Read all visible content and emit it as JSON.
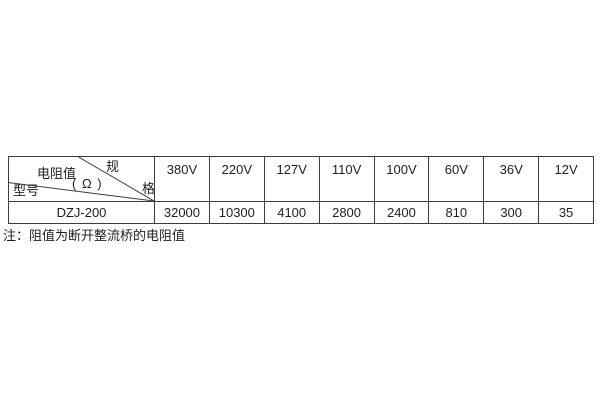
{
  "table": {
    "corner": {
      "spec_char1": "规",
      "spec_char2": "格",
      "resistance_label": "电阻值",
      "resistance_unit": "( Ω )",
      "model_label": "型号"
    },
    "voltages": [
      "380V",
      "220V",
      "127V",
      "110V",
      "100V",
      "60V",
      "36V",
      "12V"
    ],
    "model": "DZJ-200",
    "values": [
      "32000",
      "10300",
      "4100",
      "2800",
      "2400",
      "810",
      "300",
      "35"
    ]
  },
  "note": "注：阻值为断开整流桥的电阻值",
  "colors": {
    "border": "#3c3c3c",
    "text": "#1f1f1f",
    "background": "#ffffff"
  }
}
